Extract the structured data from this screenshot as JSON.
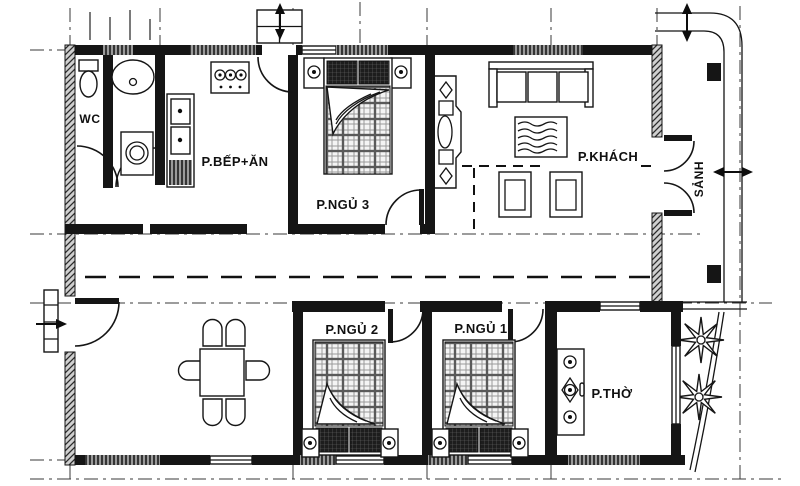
{
  "plan": {
    "rooms": {
      "wc": "WC",
      "kitchen_dining": "P.BẾP+ĂN",
      "bedroom3": "P.NGỦ 3",
      "living": "P.KHÁCH",
      "hall": "SẢNH",
      "bedroom2": "P.NGỦ 2",
      "bedroom1": "P.NGỦ 1",
      "worship": "P.THỜ"
    },
    "colors": {
      "line": "#151515",
      "paper": "#ffffff",
      "hatch": "#9a9a9a"
    }
  }
}
